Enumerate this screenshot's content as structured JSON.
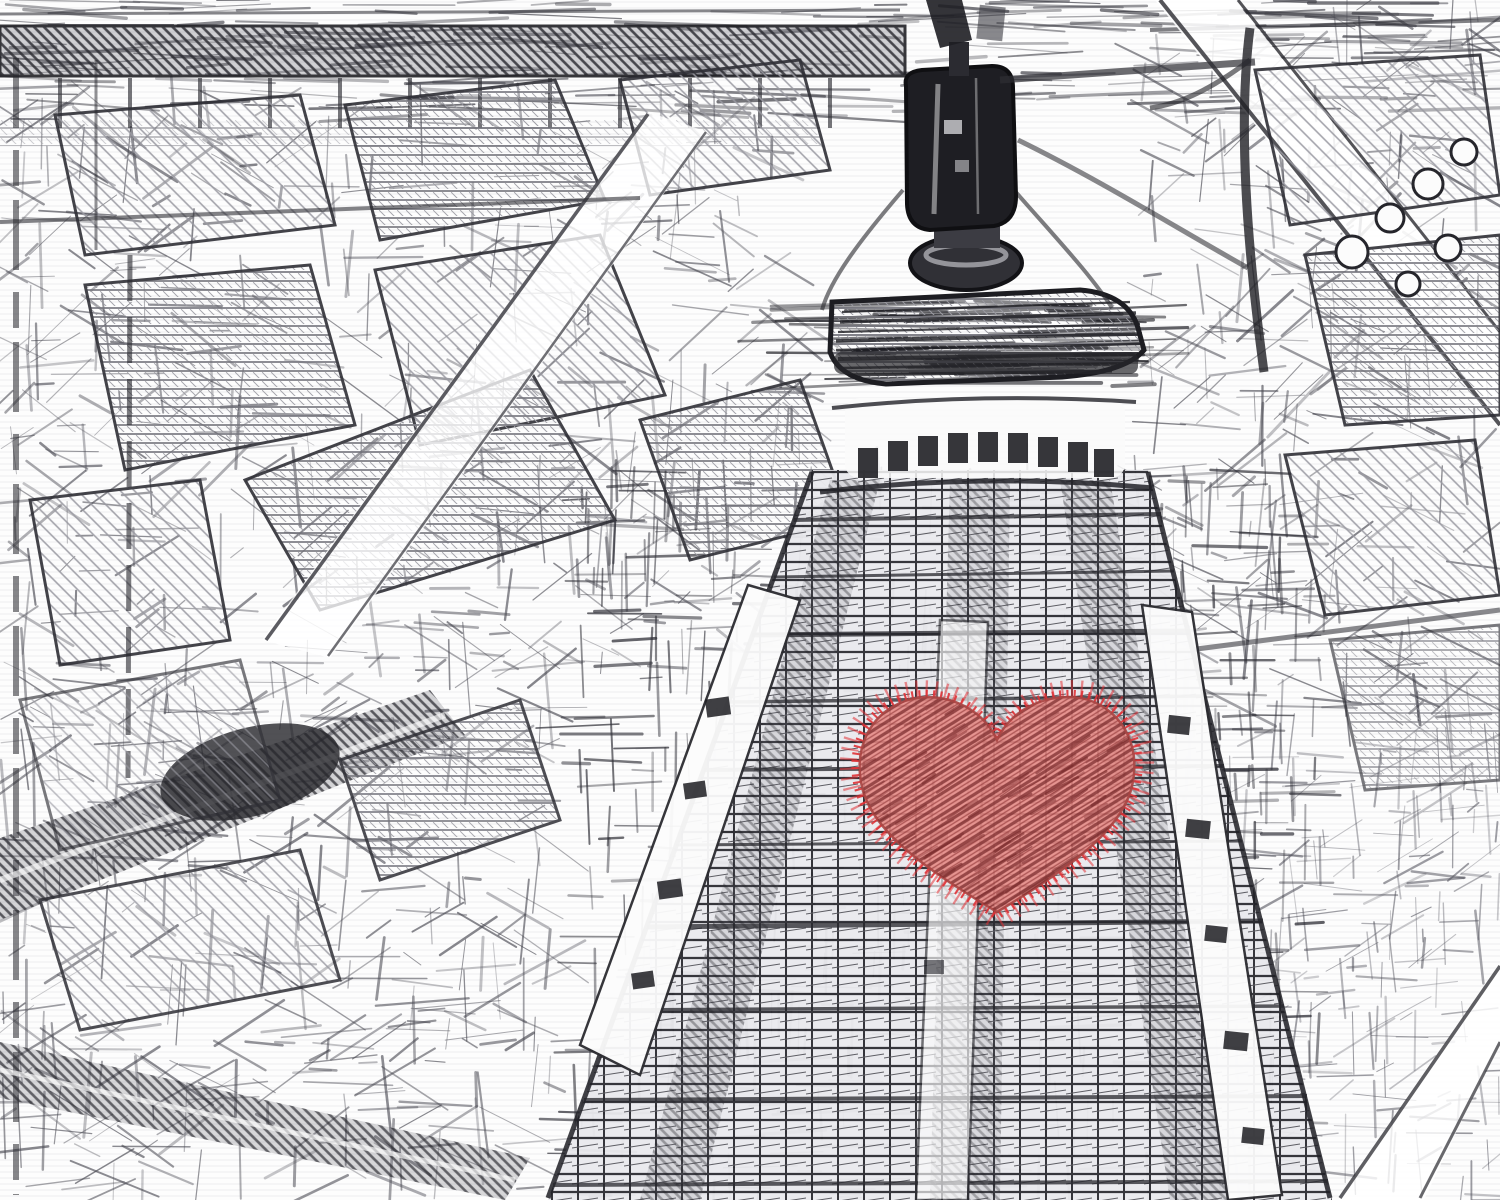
{
  "scene": {
    "type": "stylized-sketch-photo",
    "subject": "Black-and-white pencil-sketch aerial view of the Eiffel Tower rising above a Paris street grid, with a red cross-hatched stitched heart drawn over the tower",
    "palette": {
      "paper": "#fdfdfd",
      "graphite_faint": "#c4c4ca",
      "graphite_light": "#9a9aa2",
      "graphite_mid": "#6f6f77",
      "graphite_dark": "#2c2c32",
      "ink_black": "#17171b",
      "heart_fill": "#e68984",
      "heart_hatch": "#7c2d2e",
      "heart_fringe": "#e03236",
      "heart_outline": "#a84543"
    },
    "heart": {
      "cx": 997,
      "cy": 800,
      "width": 268,
      "height": 222
    }
  },
  "texture_regions": [
    {
      "name": "top-band",
      "x": 0,
      "y": 0,
      "w": 1500,
      "h": 118,
      "count": 240,
      "angles": [
        0
      ],
      "jitter": 5,
      "len": [
        30,
        150
      ],
      "width": [
        1,
        3.6
      ],
      "color": "#3c3c44",
      "opacity": 0.5
    },
    {
      "name": "city-upper-left",
      "x": 0,
      "y": 95,
      "w": 810,
      "h": 575,
      "count": 540,
      "angles": [
        0,
        32,
        -38,
        90
      ],
      "jitter": 8,
      "len": [
        14,
        85
      ],
      "width": [
        0.8,
        3
      ],
      "color": "#4b4b54",
      "opacity": 0.48
    },
    {
      "name": "city-left-lower",
      "x": 0,
      "y": 665,
      "w": 555,
      "h": 535,
      "count": 400,
      "angles": [
        0,
        30,
        -32,
        90
      ],
      "jitter": 8,
      "len": [
        14,
        95
      ],
      "width": [
        0.8,
        3
      ],
      "color": "#4b4b54",
      "opacity": 0.48
    },
    {
      "name": "city-right",
      "x": 1135,
      "y": 0,
      "w": 365,
      "h": 730,
      "count": 340,
      "angles": [
        0,
        -40,
        90,
        28
      ],
      "jitter": 8,
      "len": [
        14,
        90
      ],
      "width": [
        0.8,
        3
      ],
      "color": "#474750",
      "opacity": 0.48
    },
    {
      "name": "city-right-lower",
      "x": 1230,
      "y": 730,
      "w": 270,
      "h": 470,
      "count": 210,
      "angles": [
        0,
        -33,
        90
      ],
      "jitter": 8,
      "len": [
        12,
        75
      ],
      "width": [
        0.8,
        2.6
      ],
      "color": "#52525c",
      "opacity": 0.42
    },
    {
      "name": "tower-horizontals",
      "x": 575,
      "y": 470,
      "w": 745,
      "h": 730,
      "count": 330,
      "angles": [
        0
      ],
      "jitter": 4,
      "len": [
        20,
        85
      ],
      "width": [
        1,
        3.4
      ],
      "color": "#2f2f37",
      "opacity": 0.55
    },
    {
      "name": "tower-verticals",
      "x": 575,
      "y": 470,
      "w": 745,
      "h": 730,
      "count": 330,
      "angles": [
        90
      ],
      "jitter": 4,
      "len": [
        18,
        75
      ],
      "width": [
        1,
        3
      ],
      "color": "#2f2f37",
      "opacity": 0.5
    },
    {
      "name": "platform-streaks",
      "x": 822,
      "y": 300,
      "w": 318,
      "h": 88,
      "count": 70,
      "angles": [
        0
      ],
      "jitter": 3,
      "len": [
        40,
        200
      ],
      "width": [
        1.4,
        4
      ],
      "color": "#1f1f25",
      "opacity": 0.55
    },
    {
      "name": "heart-grain",
      "x": 860,
      "y": 688,
      "w": 276,
      "h": 228,
      "count": 140,
      "angles": [
        -32
      ],
      "jitter": 5,
      "len": [
        10,
        46
      ],
      "width": [
        1.2,
        3.2
      ],
      "color": "#7c2d2e",
      "opacity": 0.5,
      "clip": "heartClip",
      "layer": "overlay-layer"
    }
  ]
}
